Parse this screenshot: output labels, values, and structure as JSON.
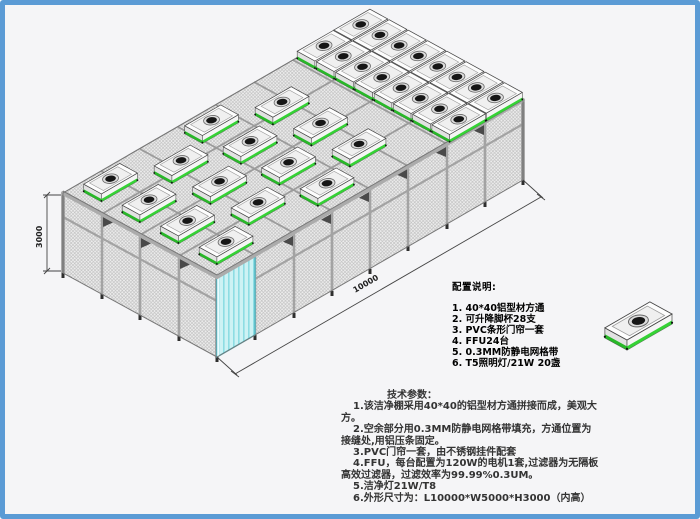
{
  "frame": {
    "border_color": "#5b9bd5",
    "background": "#f5f5f7"
  },
  "drawing": {
    "height_dim": "3000",
    "length_dim": "10000",
    "colors": {
      "ffu_green": "#35d235",
      "door_cyan": "#cdf2f4",
      "mesh_gray": "#bcbcbc",
      "frame_gray": "#9b9b9b"
    }
  },
  "config_notes": {
    "title": "配置说明:",
    "items": [
      "1. 40*40铝型材方通",
      "2. 可升降脚杯28支",
      "3. PVC条形门帘一套",
      "4. FFU24台",
      "5. 0.3MM防静电网格带",
      "6. T5照明灯/21W 20盏"
    ]
  },
  "tech_params": {
    "title": "技术参数：",
    "lines": [
      "1.该洁净棚采用40*40的铝型材方通拼接而成，美观大",
      "方。",
      "2.空余部分用0.3MM防静电网格带填充，方通位置为",
      "接缝处,用铝压条固定。",
      "3.PVC门帘一套，由不锈钢挂件配套",
      "4.FFU，每台配置为120W的电机1套,过滤器为无隔板",
      "高效过滤器，过滤效率为99.99%0.3UM。",
      "5.洁净灯21W/T8",
      "6.外形尺寸为：L10000*W5000*H3000（内高）"
    ]
  }
}
